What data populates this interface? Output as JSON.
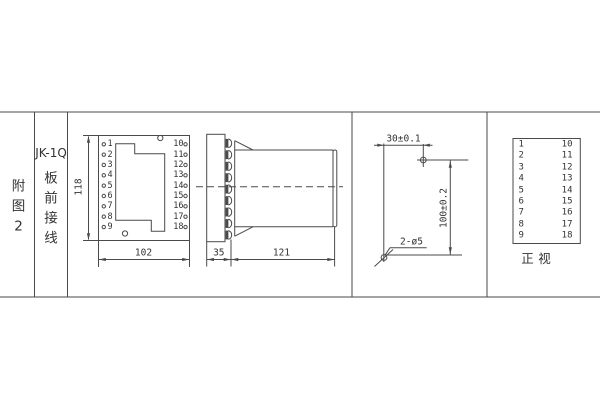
{
  "figure_label": {
    "chars": [
      "附",
      "图",
      "2"
    ]
  },
  "model_label": "JK-1Q",
  "wiring_label": {
    "chars": [
      "板",
      "前",
      "接",
      "线"
    ]
  },
  "front_view": {
    "left_terminals": [
      "1",
      "2",
      "3",
      "4",
      "5",
      "6",
      "7",
      "8",
      "9"
    ],
    "right_terminals": [
      "10",
      "11",
      "12",
      "13",
      "14",
      "15",
      "16",
      "17",
      "18"
    ],
    "height_dim": "118",
    "width_dim": "102"
  },
  "side_view": {
    "panel_depth_dim": "35",
    "body_length_dim": "121"
  },
  "drill_plan": {
    "hole_spacing_h_dim": "30±0.1",
    "hole_spacing_v_dim": "100±0.2",
    "holes_label": "2-ø5"
  },
  "terminal_table": {
    "rows": [
      [
        "1",
        "10"
      ],
      [
        "2",
        "11"
      ],
      [
        "3",
        "12"
      ],
      [
        "4",
        "13"
      ],
      [
        "5",
        "14"
      ],
      [
        "6",
        "15"
      ],
      [
        "7",
        "16"
      ],
      [
        "8",
        "17"
      ],
      [
        "9",
        "18"
      ]
    ],
    "caption_chars": [
      "正",
      "视"
    ]
  },
  "colors": {
    "line": "#4a4a4a",
    "text": "#333333",
    "background": "#ffffff"
  }
}
